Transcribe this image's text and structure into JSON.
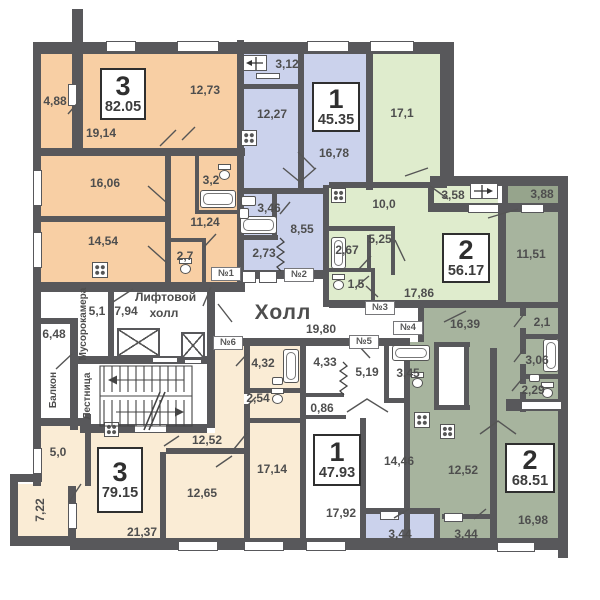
{
  "colors": {
    "wall": "#58585b",
    "apartment_orange": "#f8cfa4",
    "apartment_blue": "#cbd2ec",
    "apartment_green": "#dfeccd",
    "apartment_sage": "#a7b49e",
    "apartment_sage_dark": "#96a48c",
    "apartment_cream": "#faecd5"
  },
  "common": {
    "hall_title": "Холл",
    "hall_area": "19,80",
    "lift_hall_line1": "Лифтовой",
    "lift_hall_line2": "холл",
    "lift_hall_area": "7,94",
    "garbage_room": "Мусорокамера",
    "garbage_area": "5,1",
    "staircase": "Лестница",
    "balcony": "Балкон",
    "balcony_area": "6,48"
  },
  "door_tags": [
    "№1",
    "№2",
    "№3",
    "№4",
    "№5",
    "№6"
  ],
  "apartments": [
    {
      "rooms": "3",
      "total_area": "82.05",
      "room_areas": [
        "4,88",
        "12,73",
        "19,14",
        "16,06",
        "3,2",
        "11,24",
        "14,54",
        "2,7"
      ]
    },
    {
      "rooms": "1",
      "total_area": "45.35",
      "room_areas": [
        "3,12",
        "12,27",
        "16,78",
        "3,46",
        "8,55",
        "2,73"
      ]
    },
    {
      "rooms": "2",
      "total_area": "56.17",
      "room_areas": [
        "17,1",
        "10,0",
        "5,25",
        "2,67",
        "1,5",
        "17,86",
        "3,58"
      ]
    },
    {
      "rooms": "2",
      "total_area": "68.51",
      "room_areas": [
        "3,88",
        "11,51",
        "16,39",
        "2,1",
        "3,06",
        "2,29",
        "12,52",
        "16,98",
        "3,44"
      ]
    },
    {
      "rooms": "3",
      "total_area": "79.15",
      "room_areas": [
        "5,0",
        "7,22",
        "12,52",
        "12,65",
        "17,14",
        "21,37",
        "4,32",
        "2,54"
      ]
    },
    {
      "rooms": "1",
      "total_area": "47.93",
      "room_areas": [
        "4,33",
        "5,19",
        "3,45",
        "0,86",
        "14,46",
        "17,92",
        "3,44"
      ]
    }
  ]
}
